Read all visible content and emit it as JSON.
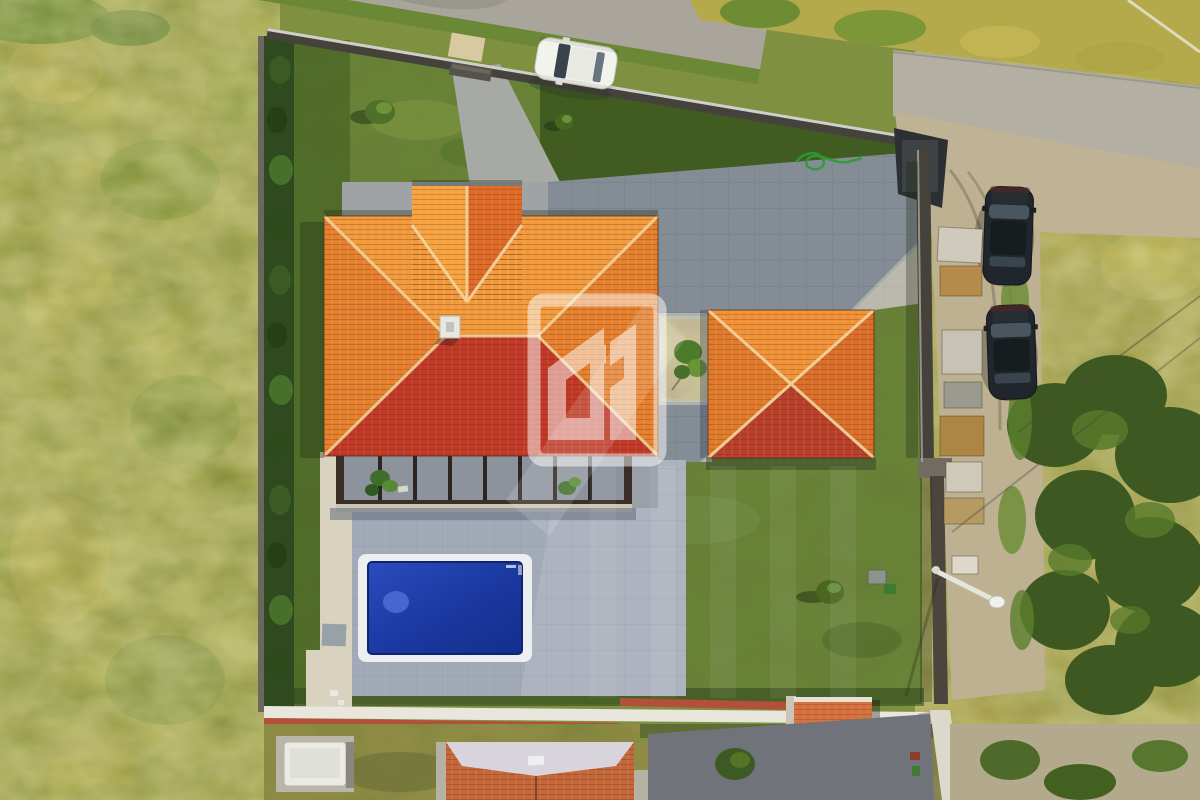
{
  "scene": {
    "type": "aerial-drone-photo",
    "subject": "Top-down view of a walled villa plot: orange hip-roof house with front gable, detached pyramid-roof garage, rectangular blue swimming pool, mown lawn, paved courtyard, perimeter hedge and white walls, roads at top and right, two dark SUVs and a white hatchback parked outside",
    "watermark": "translucent white real-estate house monogram centered on the roof"
  },
  "colors": {
    "base": "#7f9140",
    "field_left": "#a9aa4b",
    "field_right": "#aaa349",
    "road": "#a9a59b",
    "road_right": "#b3afa2",
    "dirt": "#c0b294",
    "lawn": "#69863a",
    "lawn_dark": "#3d581e",
    "paving": "#a9aca9",
    "paving_shadow": "#3a4f6e",
    "terrace": "#a2aab8",
    "walkway": "#d9d2bf",
    "pool_coping": "#eceef0",
    "pool_water_deep": "#132f8c",
    "pool_water_light": "#2b4cbe",
    "roof_lit": "#f19a3c",
    "roof_mid": "#e5812e",
    "roof_shade": "#c13a27",
    "gable_lit": "#f5a440",
    "gable_shade": "#df6b28",
    "garage_top": "#ef9238",
    "garage_left": "#e07b2c",
    "garage_right": "#d96f2a",
    "garage_shade": "#b8402a",
    "ridge": "#f3d6a0",
    "hedge": "#2e4a1e",
    "wall_dark": "#45423b",
    "wall_white": "#e9e6de",
    "wall_cap_red": "#b2503a",
    "car_white": "#f3f3ee",
    "car_dark": "#20262b",
    "trailer": "#eceae2",
    "neighbor_roof": "#c4683a",
    "neighbor_ridge": "#d9d4dc",
    "neighbor_paving": "#70747a",
    "hose_green": "#2f9a35",
    "watermark": "#ffffff"
  },
  "objects": {
    "buildings": [
      "main-house",
      "garage",
      "neighbor-house",
      "wall-gate-shed"
    ],
    "vehicles": [
      "white-car",
      "dark-suv-1",
      "dark-suv-2",
      "trailer"
    ],
    "landscape": [
      "pool",
      "lawn",
      "hedge",
      "left-field",
      "right-field",
      "tree-grove",
      "garden-bed"
    ],
    "infrastructure": [
      "top-road",
      "right-road",
      "dirt-lot",
      "perimeter-walls",
      "street-lamp",
      "power-cables"
    ]
  }
}
